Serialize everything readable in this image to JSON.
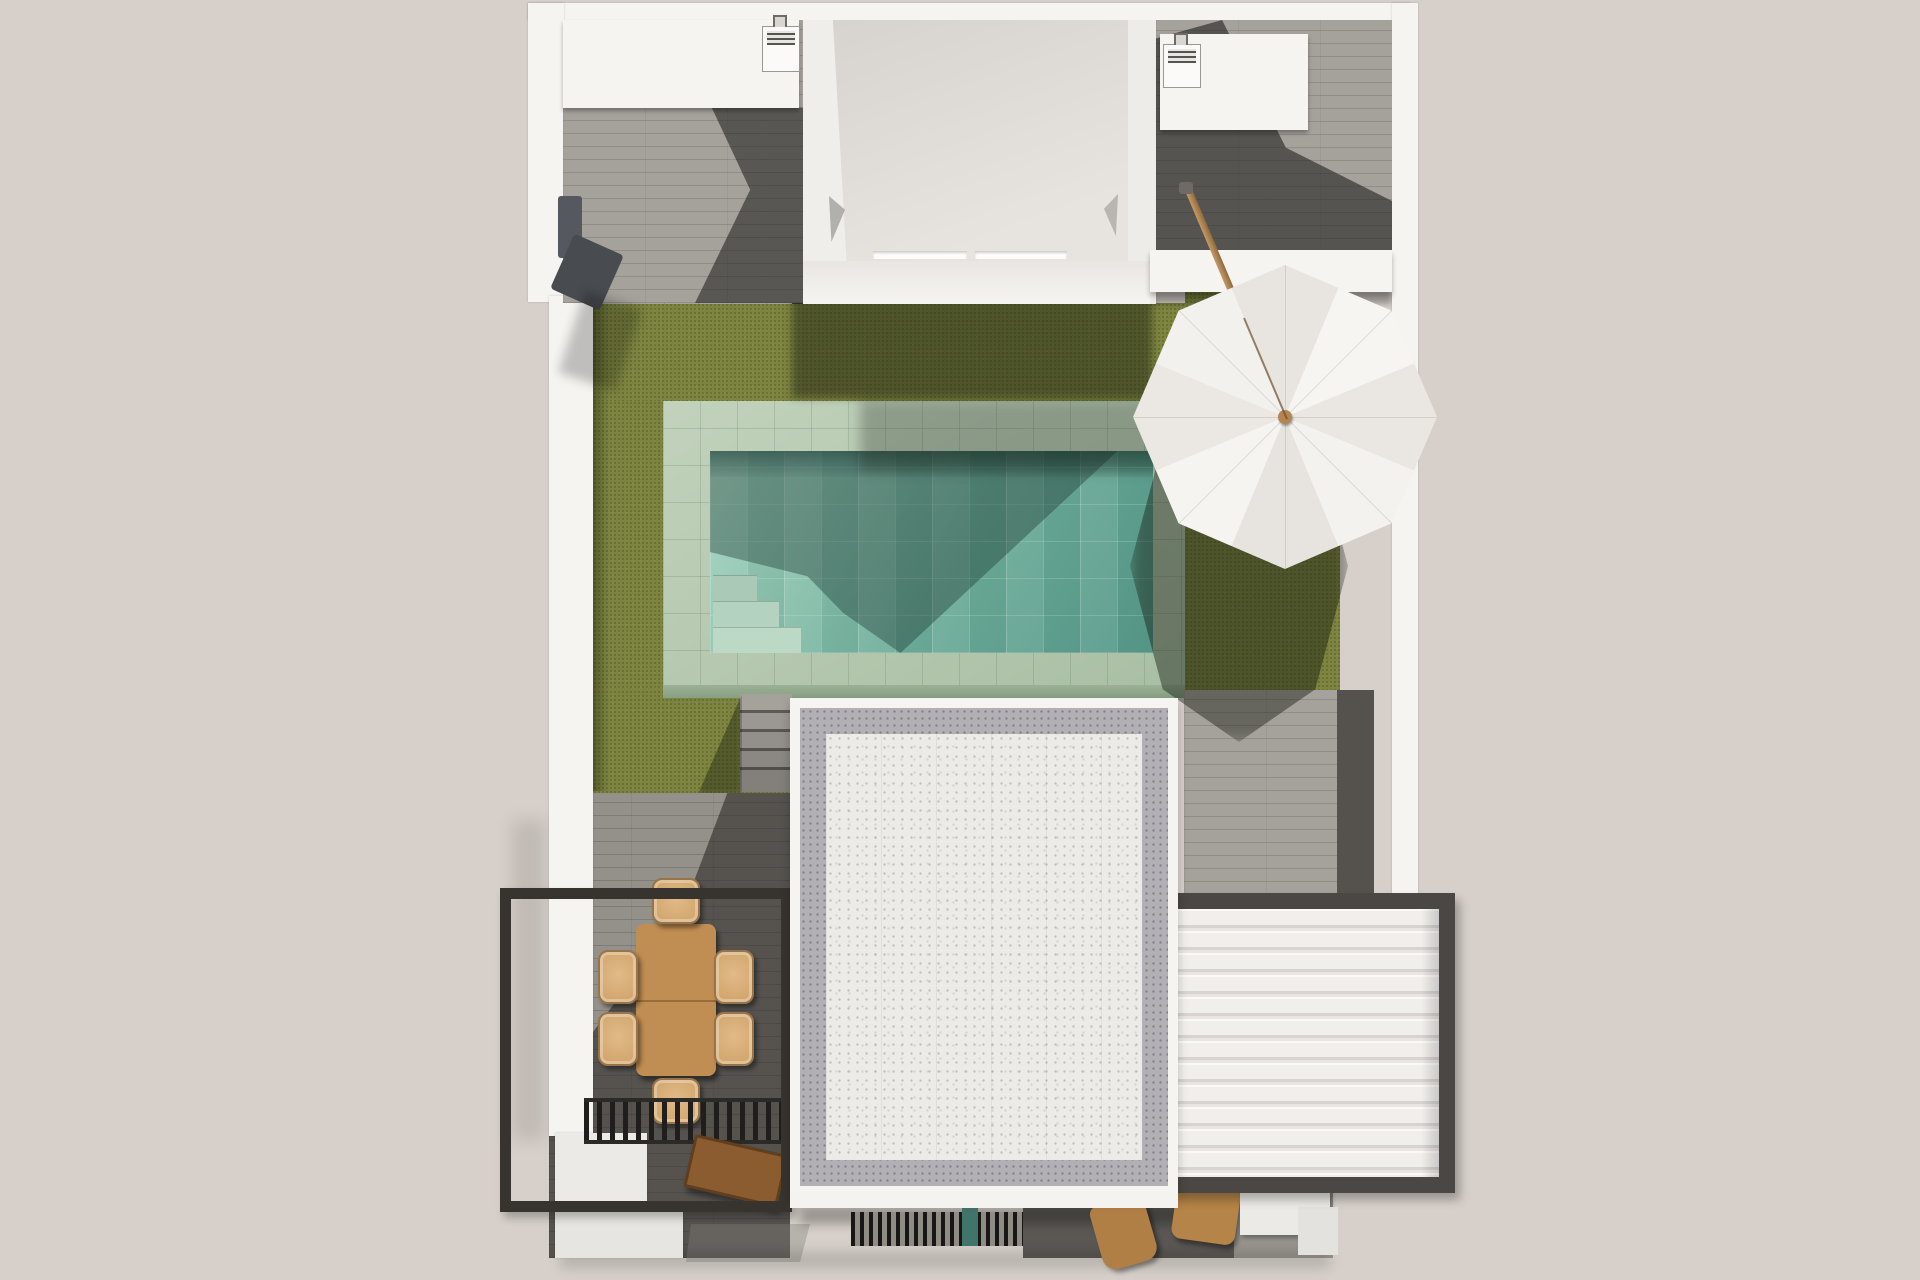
{
  "scene": {
    "title": "Aerial top-down 3D architectural rendering of a modern villa plot",
    "view": "top view, slight perspective",
    "has_text": false,
    "description": "U-shaped white villa with two roof courtyards holding AC units, central wing with slot skylights, olive lawn with raised sage-tiled pool and corner steps, white gravel flat roof with gray border, white louvered pergola, black steel dining pergola with wood table and six wicker chairs, tilted white parasol, wood benches and loungers"
  },
  "palette": {
    "bg": "#d7d0ca",
    "wall": "#f6f4f1",
    "wallShade": "#e7e4e0",
    "wingRoofA": "#d6d2ce",
    "wingRoofB": "#e7e3df",
    "deckLight": "#a5a19b",
    "deckMid": "#94908a",
    "deckDark": "#4a4846",
    "stone": "#a7a49e",
    "grass": "#7d8440",
    "grassShadow": "#434d20",
    "coping": "#a9bfa4",
    "copingLight": "#c2d2bc",
    "waterLight": "#a8d6c2",
    "waterMid": "#6fae9a",
    "waterDeep": "#58998a",
    "stepTile": "#bcd9c6",
    "roofGravel": "#edebe8",
    "roofBand": "#b2afb5",
    "louverFrame": "#4b4744",
    "steelFrame": "#37342f",
    "woodTable": "#c08d52",
    "chairWicker": "#e0ba88",
    "woodBench": "#8a5c30",
    "woodLounger": "#b07f46",
    "umbrellaA": "#f7f5f2",
    "umbrellaB": "#eae7e3",
    "umbrellaKnob": "#b5854f",
    "poleWood": "#b08a5a",
    "showerGray": "#55585e",
    "walkDark": "#55524d",
    "grateGreen": "#41746a"
  },
  "elements": {
    "left_courtyard": {
      "label": "Left roof courtyard with AC unit, storage cabinet, gray plank decking and wall-mounted outdoor shower"
    },
    "right_courtyard": {
      "label": "Right roof courtyard with AC unit, cabinet and parasol base"
    },
    "central_wing": {
      "label": "Central building wing, flat white roof with two slot skylights"
    },
    "garden": {
      "label": "Olive green artificial lawn surrounding the pool"
    },
    "pool": {
      "label": "Raised swimming pool with sage tile coping, turquoise tiled water and corner entry steps",
      "steps": 3
    },
    "garden_steps": {
      "label": "Concrete steps from pool deck down to dining terrace",
      "treads": 5
    },
    "main_roof": {
      "label": "White gravel flat roof with gray pebble border band"
    },
    "louver_pergola": {
      "label": "Bioclimatic pergola with white horizontal louvers and dark frame",
      "slat_count": 13
    },
    "dining_pergola": {
      "label": "Black steel pergola frame over dining terrace"
    },
    "dining_set": {
      "label": "Rectangular wood dining table with six wicker chairs",
      "chairs": 6
    },
    "slat_shade": {
      "label": "Black slatted shade strip",
      "slat_count": 15
    },
    "bench": {
      "label": "Wooden bench"
    },
    "grate": {
      "label": "Black floor grate with green pool-equipment unit"
    },
    "loungers": {
      "label": "Two wooden lounge chairs on dark paving",
      "count": 2
    },
    "umbrella": {
      "label": "White tilted octagonal parasol with wood pole",
      "panels": 8
    },
    "ac_units": {
      "label": "Rooftop AC condenser units",
      "count": 2
    }
  }
}
